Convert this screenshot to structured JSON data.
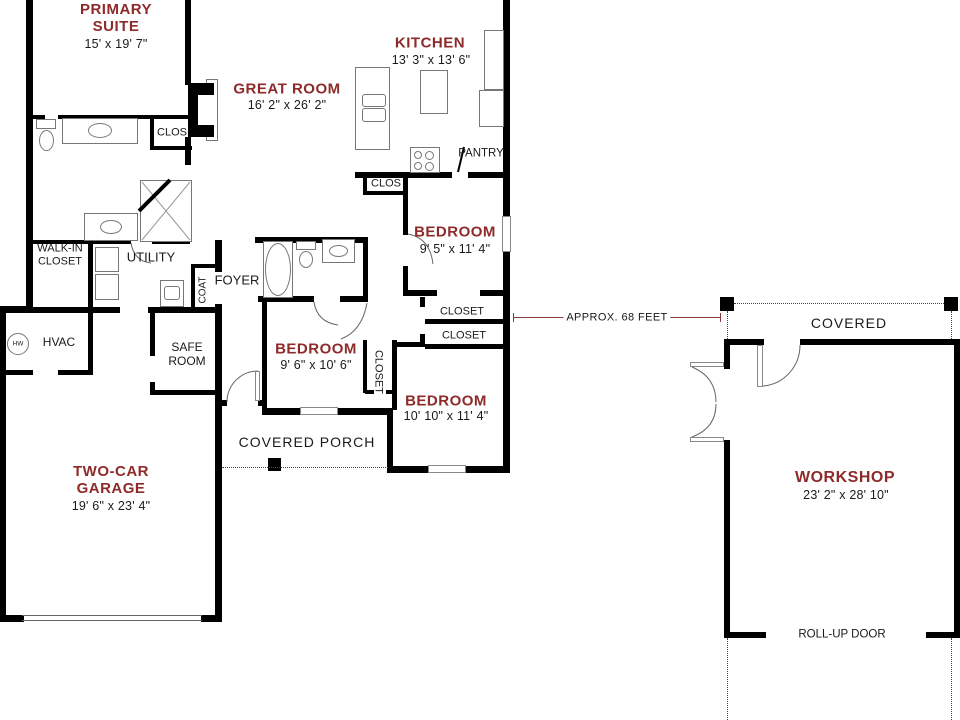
{
  "rooms": {
    "primary_suite": {
      "name": "PRIMARY SUITE",
      "dims": "15' x 19' 7\""
    },
    "great_room": {
      "name": "GREAT ROOM",
      "dims": "16' 2\" x 26' 2\""
    },
    "kitchen": {
      "name": "KITCHEN",
      "dims": "13' 3\" x 13' 6\""
    },
    "bedroom_right": {
      "name": "BEDROOM",
      "dims": "9' 5\" x 11' 4\""
    },
    "bedroom_middle": {
      "name": "BEDROOM",
      "dims": "9' 6\" x 10' 6\""
    },
    "bedroom_bottom": {
      "name": "BEDROOM",
      "dims": "10' 10\" x 11' 4\""
    },
    "garage": {
      "name": "TWO-CAR GARAGE",
      "dims": "19' 6\" x 23' 4\""
    },
    "workshop": {
      "name": "WORKSHOP",
      "dims": "23' 2\" x 28' 10\""
    }
  },
  "labels": {
    "pantry": "PANTRY",
    "clos_kitchen": "CLOS",
    "clos_primary": "CLOS",
    "closet_upper": "CLOSET",
    "closet_lower": "CLOSET",
    "closet_vertical": "CLOSET",
    "walk_in_closet": "WALK-IN CLOSET",
    "utility": "UTILITY",
    "foyer": "FOYER",
    "coat": "COAT",
    "hvac": "HVAC",
    "water_heater": "HW",
    "safe_room": "SAFE ROOM",
    "covered_porch": "COVERED PORCH",
    "covered": "COVERED",
    "roll_up_door": "ROLL-UP DOOR"
  },
  "annotations": {
    "distance": "APPROX. 68 FEET"
  },
  "colors": {
    "room_name": "#8E2A2A",
    "dimension_line": "#8C3B3B",
    "wall": "#000000",
    "text": "#1A1A1A",
    "background": "#FFFFFF"
  }
}
